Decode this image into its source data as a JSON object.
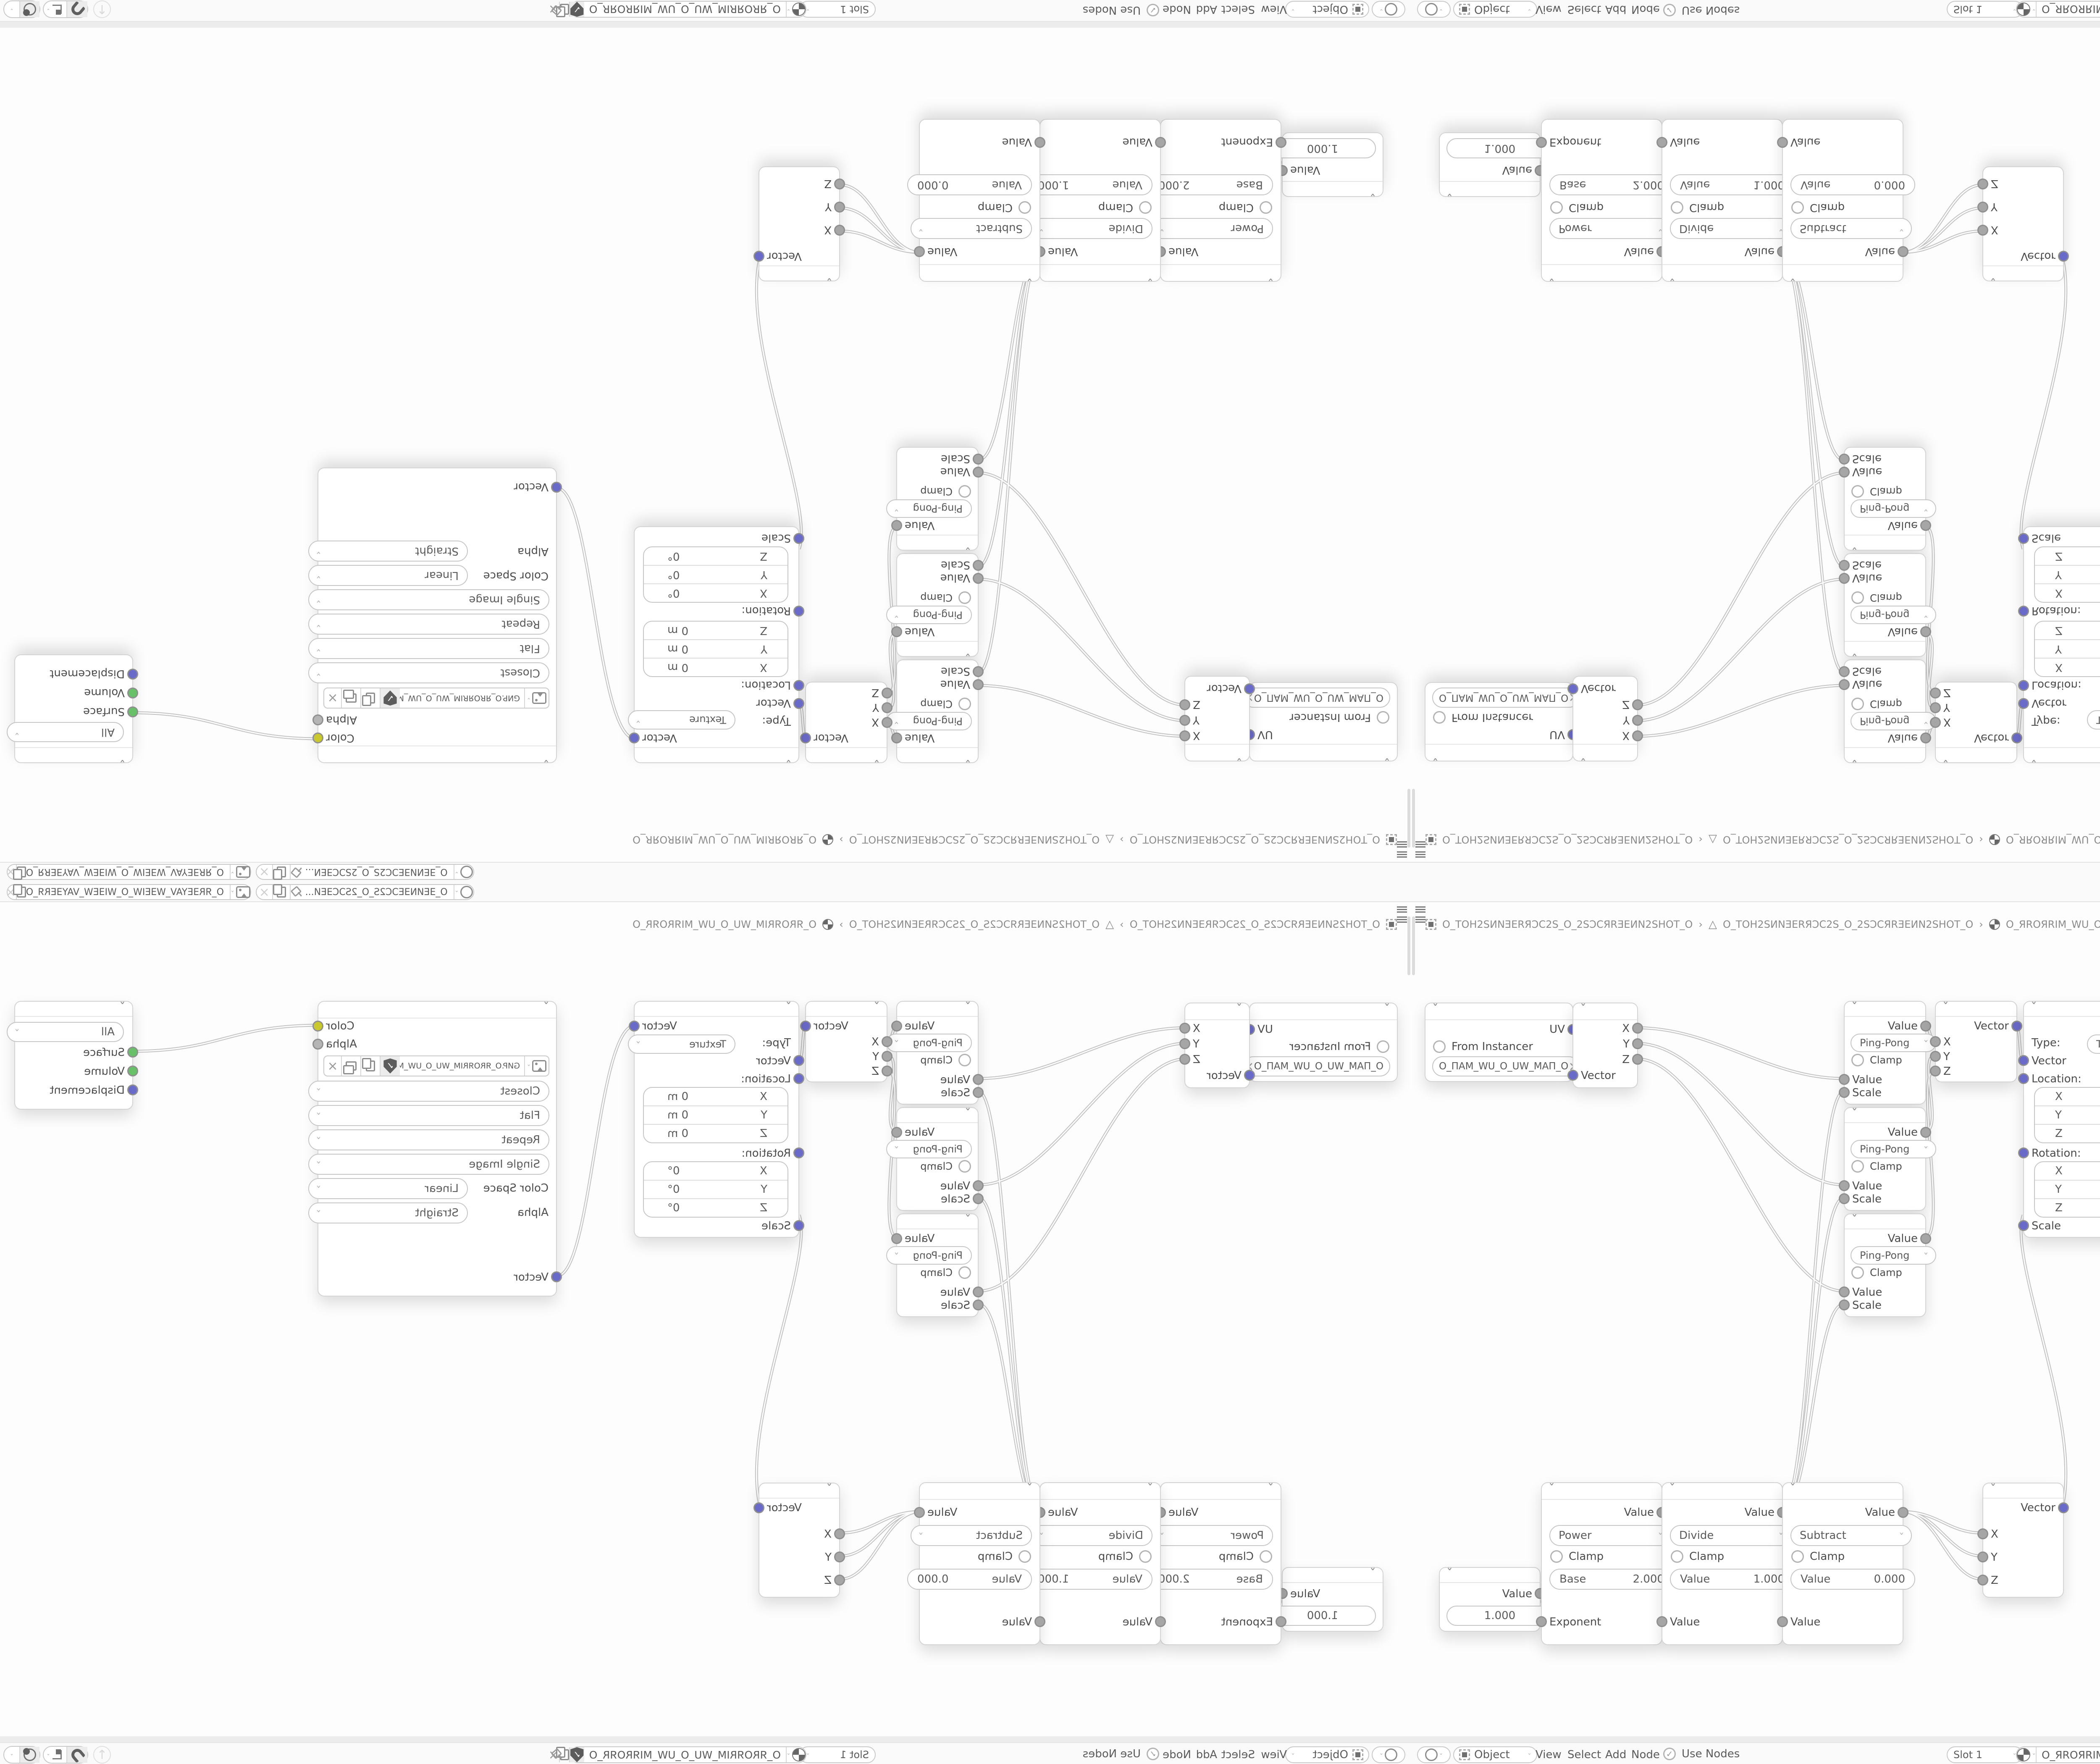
{
  "colors": {
    "vector_socket": "#6a6ac8",
    "value_socket": "#a6a6a6",
    "color_socket": "#c9c92f",
    "shader_socket": "#68c168",
    "wire_outer": "#c2c2c2",
    "canvas_bg": "#fdfdfd",
    "node_border": "#d4d4d4"
  },
  "id_strip": {
    "scene_name": "O_ƎEИNƎEƆC2S_O_2SƆCƎEИ...",
    "view_layer_name": "O_ЯRƎEYAV_WƎEIW_O_WIƎEW_VAYƎERЯ_O"
  },
  "breadcrumb": {
    "items": [
      "O_TOH2SИNƎERЯƆC2S_O_2SƆCЯRƎEИN2SHOT_O",
      "O_TOH2SИNƎERЯƆC2S_O_2SƆCЯRƎEИN2SHOT_O",
      "O_ЯROЯRIM_WU_O_UW_MIЯROЯR_O"
    ],
    "separator": "›"
  },
  "header": {
    "mode": "Object",
    "menus": [
      "View",
      "Select",
      "Add",
      "Node"
    ],
    "use_nodes": "Use Nodes",
    "slot": "Slot 1",
    "nodetree_name": "O_ЯROЯRIM_WU_O_UW_MIЯROЯR_O"
  },
  "nodes": {
    "uvmap": {
      "out": "UV",
      "from_instancer": "From Instancer",
      "uv_name": "O_ПAM_WU_O_UW_MAП_O",
      "clear": "×"
    },
    "sepxyz": {
      "x": "X",
      "y": "Y",
      "z": "Z",
      "vector": "Vector"
    },
    "pingpong": {
      "out": "Value",
      "op": "Ping-Pong",
      "clamp": "Clamp",
      "in1": "Value",
      "in2": "Scale"
    },
    "combine": {
      "out": "Vector",
      "x": "X",
      "y": "Y",
      "z": "Z"
    },
    "mapping": {
      "out": "Vector",
      "type_label": "Type:",
      "type_value": "Texture",
      "vector": "Vector",
      "location": "Location:",
      "rotation": "Rotation:",
      "scale": "Scale",
      "loc_rows": [
        {
          "axis": "X",
          "val": "0 m"
        },
        {
          "axis": "Y",
          "val": "0 m"
        },
        {
          "axis": "Z",
          "val": "0 m"
        }
      ],
      "rot_rows": [
        {
          "axis": "X",
          "val": "0°"
        },
        {
          "axis": "Y",
          "val": "0°"
        },
        {
          "axis": "Z",
          "val": "0°"
        }
      ]
    },
    "imgtex": {
      "color": "Color",
      "alpha": "Alpha",
      "filename": "GИP.O_ЯROЯRIM_WU_O_UW_MIЯROЯR_O.PNG",
      "interpolation": "Closest",
      "projection": "Flat",
      "extension": "Repeat",
      "source": "Single Image",
      "cs_label": "Color Space",
      "cs_value": "Linear",
      "alpha_label": "Alpha",
      "alpha_value": "Straight",
      "vector": "Vector",
      "clear": "×"
    },
    "output": {
      "target": "All",
      "surface": "Surface",
      "volume": "Volume",
      "displacement": "Displacement"
    },
    "value": {
      "out": "Value",
      "value": "1.000"
    },
    "math": {
      "out": "Value",
      "clamp": "Clamp"
    },
    "power": {
      "op": "Power",
      "field_label": "Base",
      "field_value": "2.000",
      "input": "Exponent"
    },
    "divide": {
      "op": "Divide",
      "field_label": "Value",
      "field_value": "1.000",
      "input": "Value"
    },
    "subtract": {
      "op": "Subtract",
      "field_label": "Value",
      "field_value": "0.000",
      "input": "Value"
    }
  }
}
